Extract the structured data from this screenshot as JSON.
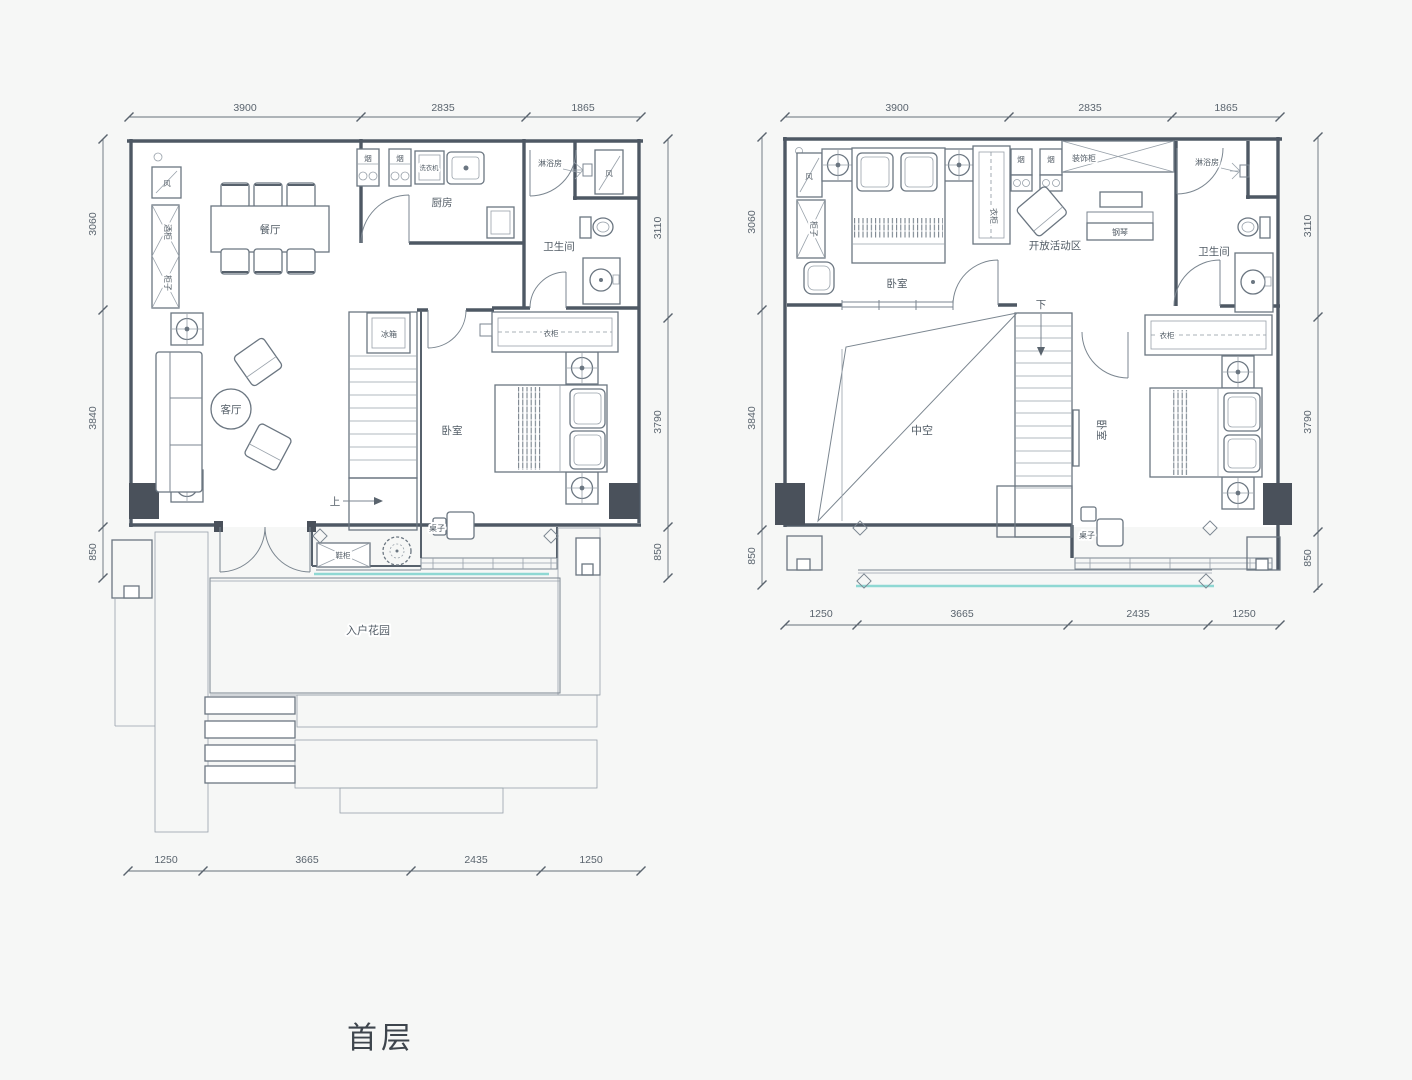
{
  "page": {
    "title": "首层",
    "background": "#f6f7f6",
    "line_color": "#4e5864",
    "accent_teal": "#8fd8d3",
    "column_fill": "#4a515b"
  },
  "floor1": {
    "dims": {
      "top": [
        "3900",
        "2835",
        "1865"
      ],
      "left": [
        "3060",
        "3840",
        "850"
      ],
      "right": [
        "3110",
        "3790",
        "850"
      ],
      "bottom": [
        "1250",
        "3665",
        "2435",
        "1250"
      ]
    },
    "labels": {
      "dining": "餐厅",
      "kitchen": "厨房",
      "washer": "洗衣机",
      "hood1": "烟",
      "hood2": "烟",
      "shower": "淋浴房",
      "bath": "卫生间",
      "vent_left": "风",
      "vent_right": "风",
      "wine_cabinet": "酒柜",
      "cabinet": "柜子",
      "living": "客厅",
      "fridge": "冰箱",
      "wardrobe": "衣柜",
      "bedroom": "卧室",
      "up": "上",
      "table": "桌子",
      "shoe_cabinet": "鞋柜",
      "garden": "入户花园"
    }
  },
  "floor2": {
    "dims": {
      "top": [
        "3900",
        "2835",
        "1865"
      ],
      "left": [
        "3060",
        "3840",
        "850"
      ],
      "right": [
        "3110",
        "3790",
        "850"
      ],
      "bottom": [
        "1250",
        "3665",
        "2435",
        "1250"
      ]
    },
    "labels": {
      "vent": "风",
      "cabinet": "柜子",
      "bedroom_top": "卧室",
      "wardrobe_side": "衣柜",
      "hood1": "烟",
      "hood2": "烟",
      "deco_cabinet": "装饰柜",
      "shower": "淋浴房",
      "activity": "开放活动区",
      "piano": "钢琴",
      "bath": "卫生间",
      "down": "下",
      "void": "中空",
      "wardrobe_row": "衣柜",
      "bedroom_right": "卧室",
      "table": "桌子"
    }
  }
}
